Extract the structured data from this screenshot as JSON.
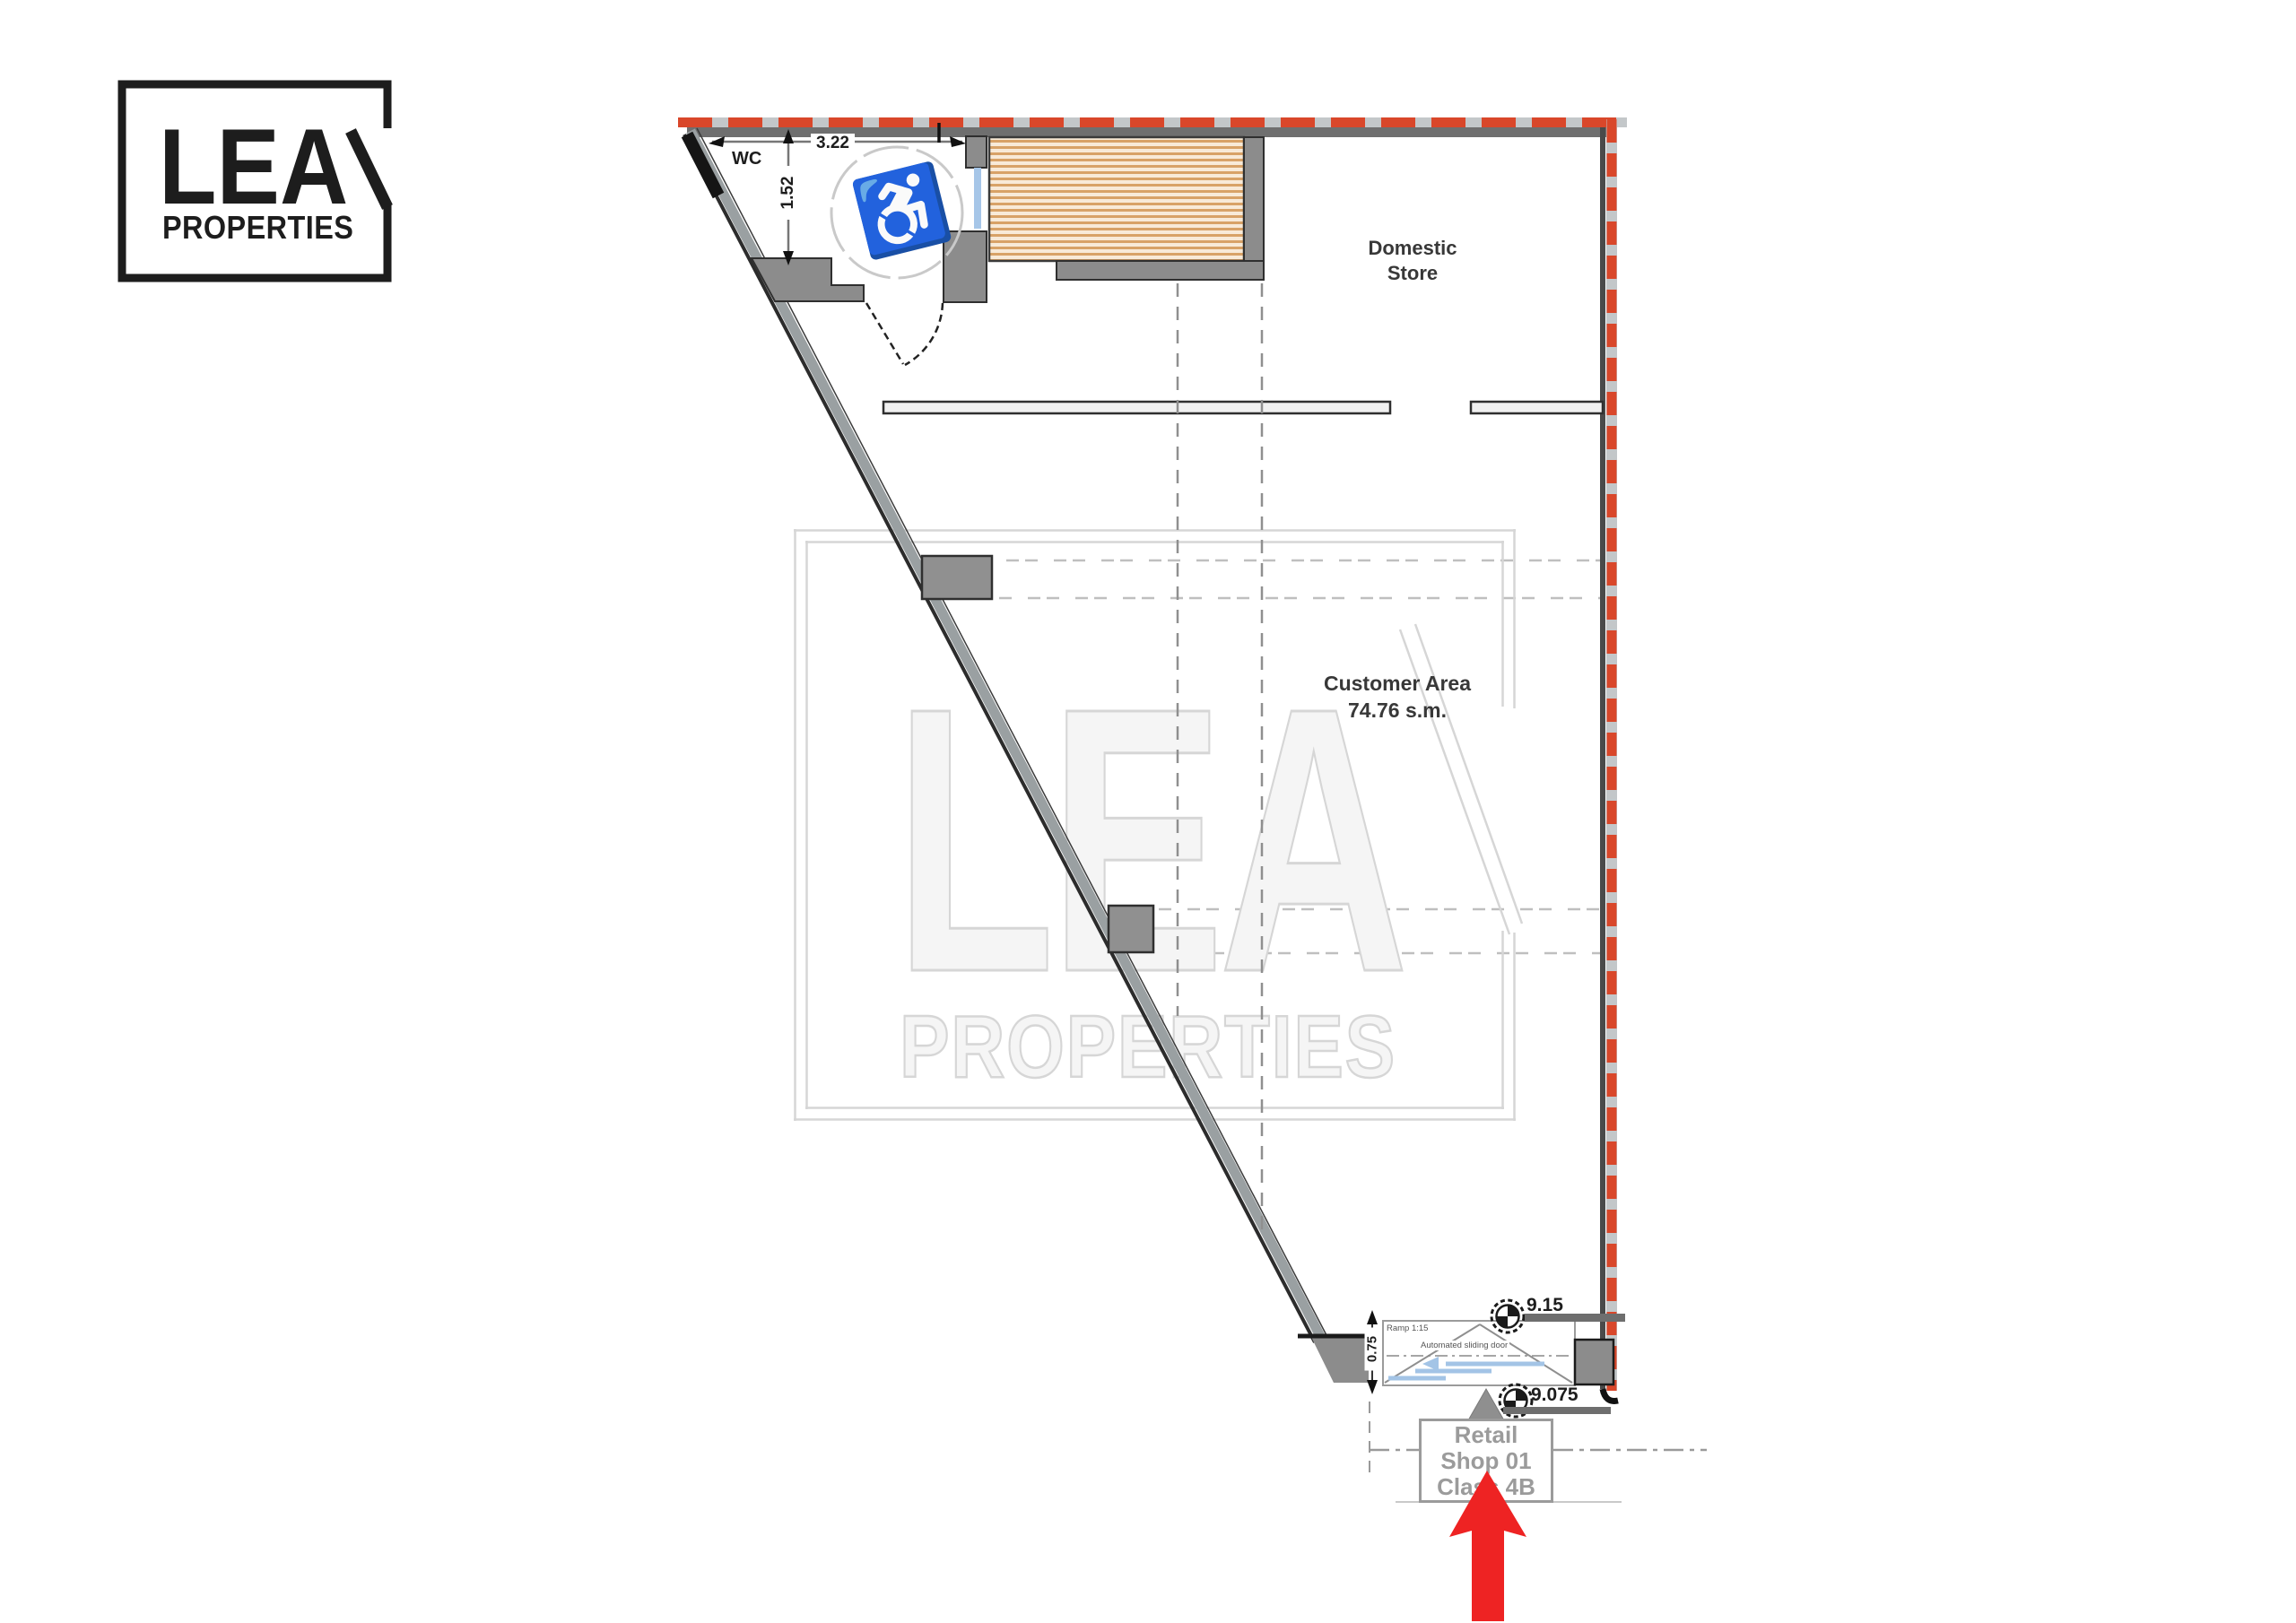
{
  "brand": {
    "name": "LEA",
    "tagline": "PROPERTIES"
  },
  "watermark": {
    "name": "LEA",
    "tagline": "PROPERTIES"
  },
  "plan": {
    "wc": {
      "label": "WC",
      "width_dim": "3.22",
      "depth_dim": "1.52"
    },
    "domestic_store": {
      "line1": "Domestic",
      "line2": "Store"
    },
    "customer_area": {
      "line1": "Customer Area",
      "line2": "74.76 s.m."
    },
    "entrance": {
      "ramp_label": "Ramp 1:15",
      "door_label": "Automated sliding door",
      "level_upper": "9.15",
      "level_lower": "9.075",
      "width_dim": "0.75"
    },
    "unit_label": {
      "line1": "Retail",
      "line2": "Shop 01",
      "line3": "Class 4B"
    }
  },
  "icons": {
    "wheelchair": "♿"
  },
  "colors": {
    "boundary_red": "#d9472a",
    "arrow_red": "#ee2323",
    "wall_gray": "#8c8c8c",
    "wall_outline": "#2f2f2f",
    "hatch_stripe": "#d8a267",
    "hatch_bg": "#f8ead8",
    "glazing_blue": "#a3c4e6",
    "watermark_gray": "#d6d6d6",
    "unit_label_gray": "#9b9b9b"
  }
}
